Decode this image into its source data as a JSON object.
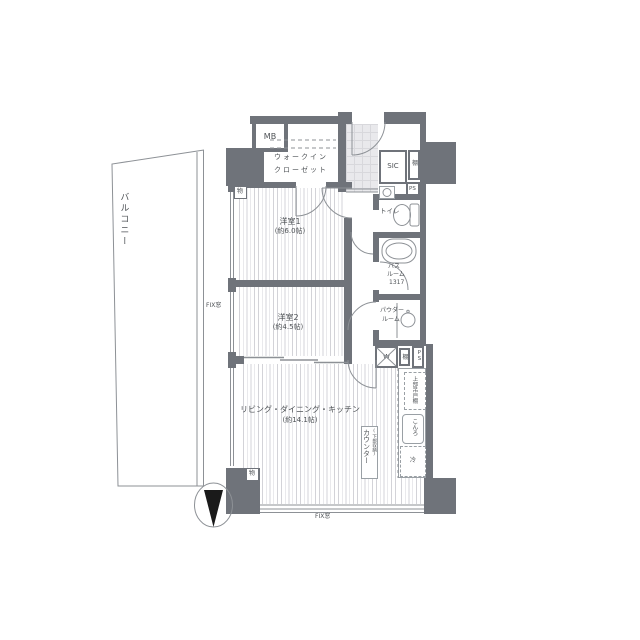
{
  "plan_type": "apartment floor plan",
  "colors": {
    "wall": "#6f737a",
    "hatch_line": "#d3d3d8",
    "thin_line": "#8d9196",
    "text": "#4e5256",
    "tile": "#e9e9ec",
    "needle": "#1a1a1a"
  },
  "balcony": {
    "label": "バルコニー",
    "fix_window_label": "FIX窓"
  },
  "bottom": {
    "fix_window_label": "FIX窓"
  },
  "rooms": {
    "bedroom1": {
      "name": "洋室1",
      "size": "(約6.0帖)"
    },
    "bedroom2": {
      "name": "洋室2",
      "size": "(約4.5帖)"
    },
    "ldk": {
      "name": "リビング・ダイニング・キッチン",
      "size": "(約14.1帖)"
    },
    "wic": {
      "line1": "ウォークイン",
      "line2": "クローゼット"
    },
    "sic": {
      "label": "SIC"
    },
    "toilet": {
      "label": "トイレ"
    },
    "bath": {
      "line1": "バス",
      "line2": "ルーム",
      "line3": "1317"
    },
    "powder": {
      "line1": "パウダー",
      "line2": "ルーム"
    }
  },
  "boxes": {
    "meter_box": "MB",
    "entry_shelf": "棚",
    "entry_pipe_space": "PS",
    "washer": "W",
    "kitchen_shelf": "棚",
    "kitchen_pipe_space": "PS",
    "upper_cabinet": "上部吊戸棚",
    "stove": "こんろ",
    "fridge": "冷",
    "counter": "カウンター",
    "counter_sub": "(下部収納)",
    "storage_north": "物",
    "storage_south": "物"
  }
}
